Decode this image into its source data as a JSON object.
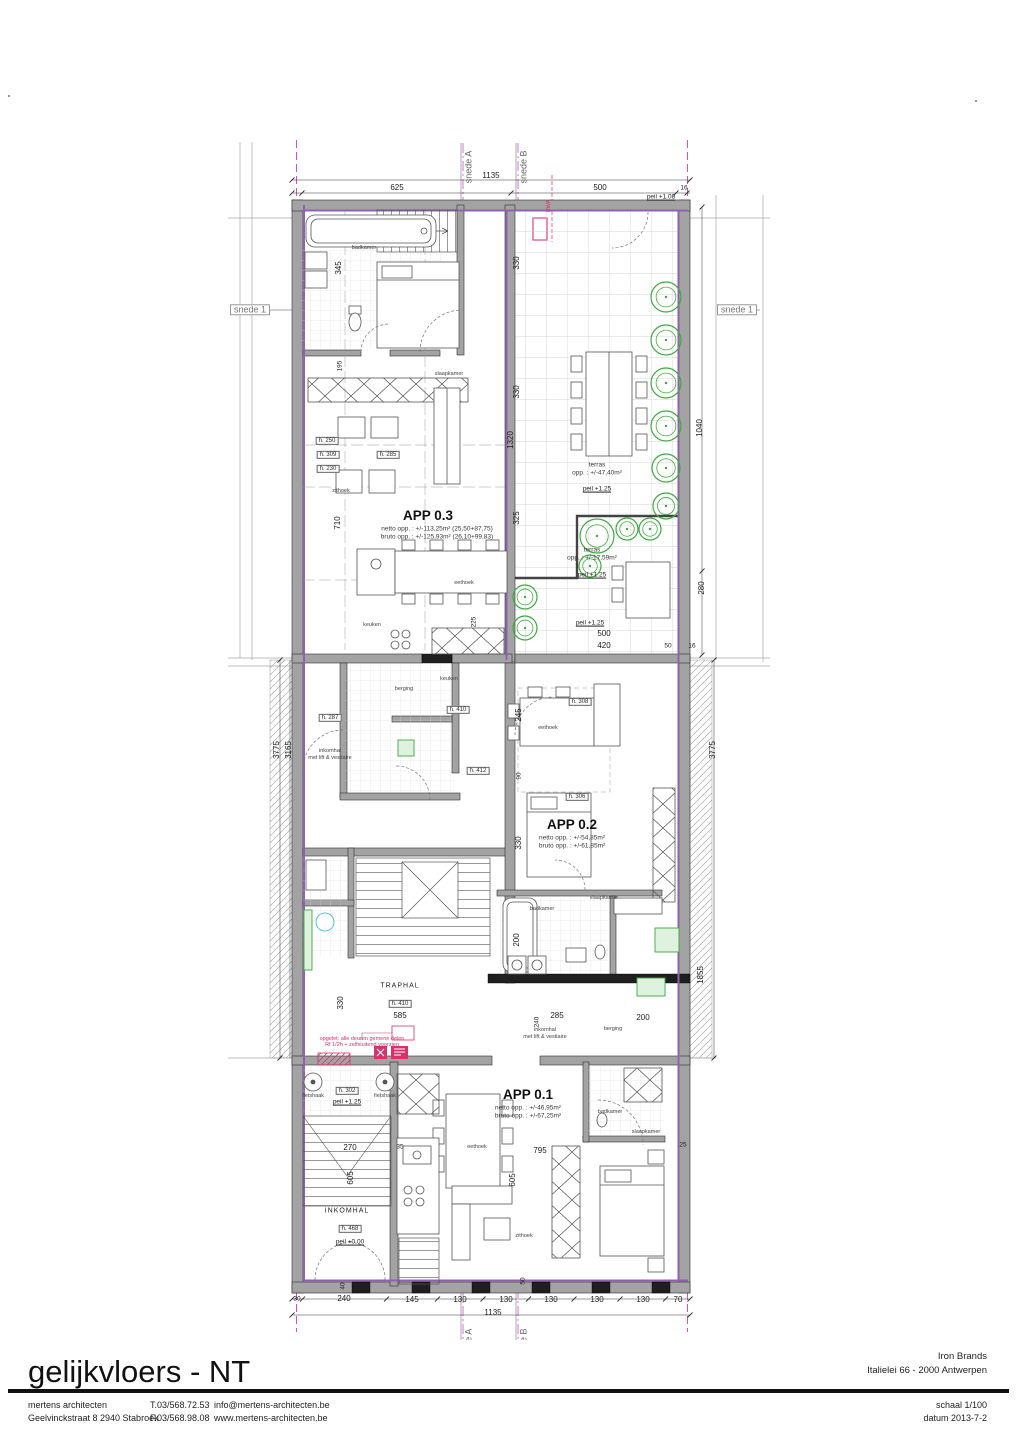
{
  "title_block": {
    "drawing_title": "gelijkvloers - NT",
    "client_name": "Iron Brands",
    "client_address": "Italielei 66 - 2000 Antwerpen",
    "firm_name": "mertens architecten",
    "firm_address": "Geelvinckstraat 8  2940 Stabroek",
    "firm_phone": "T.03/568.72.53",
    "firm_fax": "F.03/568.98.08",
    "firm_email": "info@mertens-architecten.be",
    "firm_website": "www.mertens-architecten.be",
    "scale_label": "schaal 1/100",
    "date_label": "datum 2013-7-2"
  },
  "plan": {
    "colors": {
      "wall_gray": "#a3a3a3",
      "wall_dark": "#1f1f1f",
      "insulation_purple": "#9061b0",
      "section_magenta": "#cf4fcf",
      "tree_green": "#3faa3f",
      "fixture_green": "#dff2df",
      "note_red": "#d6336c",
      "tile_gray": "#c9c9c9"
    },
    "apartments": [
      {
        "name": "APP 0.3",
        "netto": "netto opp. : +/-113,25m² (25,50+87,75)",
        "bruto": "bruto opp. : +/-125,93m² (26,10+99,83)"
      },
      {
        "name": "APP 0.2",
        "netto": "netto opp. : +/-54,85m²",
        "bruto": "bruto opp. : +/-61,85m²"
      },
      {
        "name": "APP 0.1",
        "netto": "netto opp. : +/-46,95m²",
        "bruto": "bruto opp. : +/-67,25m²"
      }
    ],
    "labels": [
      {
        "text": "snede A",
        "x": 469,
        "y": 167,
        "rot": -90,
        "cls": "sectionv",
        "name": "section-marker-a-top"
      },
      {
        "text": "snede B",
        "x": 524,
        "y": 167,
        "rot": -90,
        "cls": "sectionv",
        "name": "section-marker-b-top"
      },
      {
        "text": "snede A",
        "x": 469,
        "y": 1345,
        "rot": -90,
        "cls": "sectionv",
        "name": "section-marker-a-bottom"
      },
      {
        "text": "snede B",
        "x": 524,
        "y": 1345,
        "rot": -90,
        "cls": "sectionv",
        "name": "section-marker-b-bottom"
      },
      {
        "text": "snede 1",
        "x": 250,
        "y": 310,
        "cls": "section",
        "name": "section-marker-1-left"
      },
      {
        "text": "snede 1",
        "x": 737,
        "y": 310,
        "cls": "section",
        "name": "section-marker-1-right"
      },
      {
        "text": "1135",
        "x": 491,
        "y": 176,
        "cls": "dim"
      },
      {
        "text": "625",
        "x": 397,
        "y": 188,
        "cls": "dim"
      },
      {
        "text": "500",
        "x": 600,
        "y": 188,
        "cls": "dim"
      },
      {
        "text": "16",
        "x": 684,
        "y": 189,
        "cls": "sm"
      },
      {
        "text": "peil +1.08",
        "x": 661,
        "y": 198,
        "cls": "peil"
      },
      {
        "text": "345",
        "x": 339,
        "y": 268,
        "rot": -90,
        "cls": "dim"
      },
      {
        "text": "195",
        "x": 341,
        "y": 366,
        "rot": -90,
        "cls": "sm"
      },
      {
        "text": "710",
        "x": 338,
        "y": 523,
        "rot": -90,
        "cls": "dim"
      },
      {
        "text": "3775",
        "x": 277,
        "y": 750,
        "rot": -90,
        "cls": "dim"
      },
      {
        "text": "3165",
        "x": 289,
        "y": 750,
        "rot": -90,
        "cls": "dim"
      },
      {
        "text": "330",
        "x": 341,
        "y": 1003,
        "rot": -90,
        "cls": "dim"
      },
      {
        "text": "605",
        "x": 351,
        "y": 1178,
        "rot": -90,
        "cls": "dim"
      },
      {
        "text": "330",
        "x": 517,
        "y": 263,
        "rot": -90,
        "cls": "dim"
      },
      {
        "text": "330",
        "x": 517,
        "y": 392,
        "rot": -90,
        "cls": "dim"
      },
      {
        "text": "1320",
        "x": 511,
        "y": 440,
        "rot": -90,
        "cls": "dim"
      },
      {
        "text": "325",
        "x": 517,
        "y": 518,
        "rot": -90,
        "cls": "dim"
      },
      {
        "text": "225",
        "x": 475,
        "y": 622,
        "rot": -90,
        "cls": "sm"
      },
      {
        "text": "1040",
        "x": 700,
        "y": 428,
        "rot": -90,
        "cls": "dim"
      },
      {
        "text": "280",
        "x": 702,
        "y": 588,
        "rot": -90,
        "cls": "dim"
      },
      {
        "text": "3775",
        "x": 713,
        "y": 750,
        "rot": -90,
        "cls": "dim"
      },
      {
        "text": "245",
        "x": 519,
        "y": 715,
        "rot": -90,
        "cls": "dim"
      },
      {
        "text": "90",
        "x": 520,
        "y": 776,
        "rot": -90,
        "cls": "sm"
      },
      {
        "text": "330",
        "x": 519,
        "y": 843,
        "rot": -90,
        "cls": "dim"
      },
      {
        "text": "200",
        "x": 517,
        "y": 940,
        "rot": -90,
        "cls": "dim"
      },
      {
        "text": "1855",
        "x": 701,
        "y": 975,
        "rot": -90,
        "cls": "dim"
      },
      {
        "text": "240",
        "x": 538,
        "y": 1022,
        "rot": -90,
        "cls": "sm"
      },
      {
        "text": "605",
        "x": 513,
        "y": 1180,
        "rot": -90,
        "cls": "dim"
      },
      {
        "text": "50",
        "x": 524,
        "y": 1281,
        "rot": -90,
        "cls": "sm"
      },
      {
        "text": "40",
        "x": 344,
        "y": 1286,
        "rot": -90,
        "cls": "sm"
      },
      {
        "text": "25",
        "x": 683,
        "y": 1146,
        "cls": "sm"
      },
      {
        "text": "terras",
        "x": 597,
        "y": 466,
        "cls": "room"
      },
      {
        "text": "opp. : +/-47,40m²",
        "x": 597,
        "y": 474,
        "cls": "appsub"
      },
      {
        "text": "peil +1.25",
        "x": 597,
        "y": 490,
        "cls": "peil"
      },
      {
        "text": "terras",
        "x": 592,
        "y": 551,
        "cls": "room"
      },
      {
        "text": "opp. : +/-17,59m²",
        "x": 592,
        "y": 559,
        "cls": "appsub"
      },
      {
        "text": "peil +1.25",
        "x": 592,
        "y": 576,
        "cls": "peil"
      },
      {
        "text": "peil +1.25",
        "x": 590,
        "y": 624,
        "cls": "peil"
      },
      {
        "text": "500",
        "x": 604,
        "y": 634,
        "cls": "dim"
      },
      {
        "text": "420",
        "x": 604,
        "y": 646,
        "cls": "dim"
      },
      {
        "text": "50",
        "x": 668,
        "y": 647,
        "cls": "sm"
      },
      {
        "text": "16",
        "x": 692,
        "y": 647,
        "cls": "sm"
      },
      {
        "text": "APP 0.3",
        "x": 428,
        "y": 516,
        "cls": "apptitle",
        "name": "app-03-title"
      },
      {
        "text": "netto opp. : +/-113,25m² (25,50+87,75)",
        "x": 437,
        "y": 530,
        "cls": "appsub"
      },
      {
        "text": "bruto opp. : +/-125,93m² (26,10+99,83)",
        "x": 437,
        "y": 538,
        "cls": "appsub"
      },
      {
        "text": "APP 0.2",
        "x": 572,
        "y": 825,
        "cls": "apptitle",
        "name": "app-02-title"
      },
      {
        "text": "netto opp. : +/-54,85m²",
        "x": 572,
        "y": 839,
        "cls": "appsub"
      },
      {
        "text": "bruto opp. : +/-61,85m²",
        "x": 572,
        "y": 847,
        "cls": "appsub"
      },
      {
        "text": "APP 0.1",
        "x": 528,
        "y": 1095,
        "cls": "apptitle",
        "name": "app-01-title"
      },
      {
        "text": "netto opp. : +/-46,95m²",
        "x": 528,
        "y": 1109,
        "cls": "appsub"
      },
      {
        "text": "bruto opp. : +/-67,25m²",
        "x": 528,
        "y": 1117,
        "cls": "appsub"
      },
      {
        "text": "badkamer",
        "x": 364,
        "y": 249,
        "cls": "tiny"
      },
      {
        "text": "slaapkamer",
        "x": 449,
        "y": 375,
        "cls": "tiny"
      },
      {
        "text": "zithoek",
        "x": 341,
        "y": 492,
        "cls": "tiny"
      },
      {
        "text": "eethoek",
        "x": 464,
        "y": 584,
        "cls": "tiny"
      },
      {
        "text": "keuken",
        "x": 372,
        "y": 626,
        "cls": "tiny"
      },
      {
        "text": "keuken",
        "x": 449,
        "y": 680,
        "cls": "tiny"
      },
      {
        "text": "berging",
        "x": 404,
        "y": 690,
        "cls": "tiny"
      },
      {
        "text": "inkomhal",
        "x": 330,
        "y": 752,
        "cls": "tiny"
      },
      {
        "text": "met lift & vestiaire",
        "x": 330,
        "y": 759,
        "cls": "tiny"
      },
      {
        "text": "eethoek",
        "x": 548,
        "y": 729,
        "cls": "tiny"
      },
      {
        "text": "h. 308",
        "x": 580,
        "y": 702,
        "cls": "boxed"
      },
      {
        "text": "h. 306",
        "x": 577,
        "y": 797,
        "cls": "boxed"
      },
      {
        "text": "slaapkamer",
        "x": 604,
        "y": 899,
        "cls": "tiny"
      },
      {
        "text": "badkamer",
        "x": 542,
        "y": 910,
        "cls": "tiny"
      },
      {
        "text": "berging",
        "x": 613,
        "y": 1030,
        "cls": "tiny"
      },
      {
        "text": "inkomhal",
        "x": 545,
        "y": 1031,
        "cls": "tiny"
      },
      {
        "text": "met lift & vestiaire",
        "x": 545,
        "y": 1038,
        "cls": "tiny"
      },
      {
        "text": "TRAPHAL",
        "x": 400,
        "y": 986,
        "cls": "roomc"
      },
      {
        "text": "h. 410",
        "x": 400,
        "y": 1004,
        "cls": "boxed"
      },
      {
        "text": "585",
        "x": 400,
        "y": 1016,
        "cls": "dim"
      },
      {
        "text": "285",
        "x": 557,
        "y": 1016,
        "cls": "dim"
      },
      {
        "text": "200",
        "x": 643,
        "y": 1018,
        "cls": "dim"
      },
      {
        "text": "INKOMHAL",
        "x": 347,
        "y": 1211,
        "cls": "roomc"
      },
      {
        "text": "h. 468",
        "x": 350,
        "y": 1229,
        "cls": "boxed"
      },
      {
        "text": "peil +0.00",
        "x": 350,
        "y": 1243,
        "cls": "peil"
      },
      {
        "text": "fietshaak",
        "x": 313,
        "y": 1097,
        "cls": "tiny"
      },
      {
        "text": "fietshaak",
        "x": 385,
        "y": 1097,
        "cls": "tiny"
      },
      {
        "text": "h. 302",
        "x": 347,
        "y": 1091,
        "cls": "boxed"
      },
      {
        "text": "peil +1.25",
        "x": 347,
        "y": 1103,
        "cls": "peil"
      },
      {
        "text": "badkamer",
        "x": 610,
        "y": 1113,
        "cls": "tiny"
      },
      {
        "text": "slaapkamer",
        "x": 646,
        "y": 1133,
        "cls": "tiny"
      },
      {
        "text": "eethoek",
        "x": 477,
        "y": 1148,
        "cls": "tiny"
      },
      {
        "text": "zithoek",
        "x": 524,
        "y": 1237,
        "cls": "tiny"
      },
      {
        "text": "795",
        "x": 540,
        "y": 1151,
        "cls": "dim"
      },
      {
        "text": "270",
        "x": 350,
        "y": 1148,
        "cls": "dim"
      },
      {
        "text": "35",
        "x": 400,
        "y": 1148,
        "cls": "sm"
      },
      {
        "text": "h. 250",
        "x": 327,
        "y": 441,
        "cls": "boxed"
      },
      {
        "text": "h. 309",
        "x": 328,
        "y": 455,
        "cls": "boxed"
      },
      {
        "text": "h. 230",
        "x": 328,
        "y": 469,
        "cls": "boxed"
      },
      {
        "text": "h. 285",
        "x": 388,
        "y": 455,
        "cls": "boxed"
      },
      {
        "text": "h. 287",
        "x": 330,
        "y": 718,
        "cls": "boxed"
      },
      {
        "text": "h. 410",
        "x": 458,
        "y": 710,
        "cls": "boxed"
      },
      {
        "text": "h. 412",
        "x": 478,
        "y": 771,
        "cls": "boxed"
      },
      {
        "text": "30",
        "x": 297,
        "y": 1300,
        "cls": "sm"
      },
      {
        "text": "240",
        "x": 344,
        "y": 1299,
        "cls": "dim"
      },
      {
        "text": "145",
        "x": 412,
        "y": 1300,
        "cls": "dim"
      },
      {
        "text": "130",
        "x": 460,
        "y": 1300,
        "cls": "dim"
      },
      {
        "text": "130",
        "x": 506,
        "y": 1300,
        "cls": "dim"
      },
      {
        "text": "130",
        "x": 551,
        "y": 1300,
        "cls": "dim"
      },
      {
        "text": "130",
        "x": 597,
        "y": 1300,
        "cls": "dim"
      },
      {
        "text": "130",
        "x": 643,
        "y": 1300,
        "cls": "dim"
      },
      {
        "text": "70",
        "x": 678,
        "y": 1300,
        "cls": "dim"
      },
      {
        "text": "1135",
        "x": 493,
        "y": 1313,
        "cls": "dim"
      },
      {
        "text": "opgelet: alle deuren gemene delen",
        "x": 362,
        "y": 1040,
        "cls": "red",
        "name": "fire-note"
      },
      {
        "text": "Rf 1/2h + zelfsluitend voorzien",
        "x": 362,
        "y": 1046,
        "cls": "red",
        "name": "fire-note"
      },
      {
        "text": "RWA",
        "x": 550,
        "y": 206,
        "rot": -90,
        "cls": "red",
        "name": "rainwater-note"
      }
    ],
    "trees": [
      {
        "x": 666,
        "y": 297,
        "r": 15
      },
      {
        "x": 666,
        "y": 340,
        "r": 15
      },
      {
        "x": 666,
        "y": 383,
        "r": 15
      },
      {
        "x": 666,
        "y": 426,
        "r": 15
      },
      {
        "x": 666,
        "y": 468,
        "r": 14
      },
      {
        "x": 666,
        "y": 506,
        "r": 13
      },
      {
        "x": 597,
        "y": 536,
        "r": 17
      },
      {
        "x": 627,
        "y": 529,
        "r": 11
      },
      {
        "x": 650,
        "y": 529,
        "r": 11
      },
      {
        "x": 590,
        "y": 566,
        "r": 11
      },
      {
        "x": 525,
        "y": 597,
        "r": 12
      },
      {
        "x": 525,
        "y": 628,
        "r": 12
      }
    ]
  }
}
